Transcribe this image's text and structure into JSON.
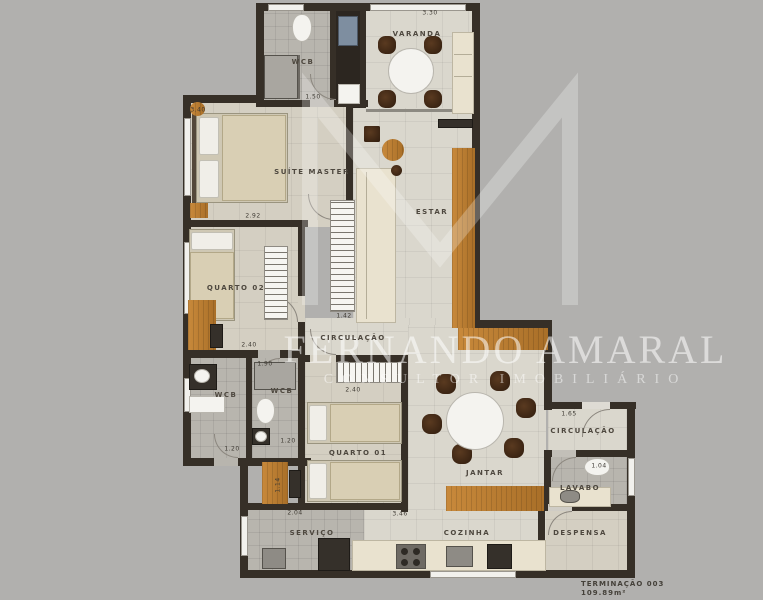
{
  "palette": {
    "background": "#b1b0ae",
    "wall": "#362f27",
    "wood_accent": "#bd7e33",
    "floor_light": "#dad7cd",
    "floor_beige": "#d4cfc2",
    "floor_tile": "#b8b5ae",
    "counter_cream": "#e9e2cf",
    "chair_dark": "#3b2517",
    "label_text": "#4e483f",
    "watermark_white": "rgba(255,255,255,0.55)"
  },
  "watermark": {
    "name": "FERNANDO AMARAL",
    "title": "CONSULTOR IMOBILIÁRIO"
  },
  "unit": {
    "code": "TERMINAÇÃO 003",
    "area": "109.89m²"
  },
  "plan": {
    "rooms": [
      {
        "label": "VARANDA"
      },
      {
        "label": "WCB"
      },
      {
        "label": "SUÍTE MASTER"
      },
      {
        "label": "ESTAR"
      },
      {
        "label": "QUARTO 02"
      },
      {
        "label": "CIRCULAÇÃO"
      },
      {
        "label": "WCB"
      },
      {
        "label": "WCB"
      },
      {
        "label": "QUARTO 01"
      },
      {
        "label": "JANTAR"
      },
      {
        "label": "CIRCULAÇÃO"
      },
      {
        "label": "LAVABO"
      },
      {
        "label": "DESPENSA"
      },
      {
        "label": "SERVIÇO"
      },
      {
        "label": "COZINHA"
      }
    ],
    "dimensions": [
      "3.30",
      "3.40",
      "1.50",
      "2.92",
      "1.42",
      "2.40",
      "1.90",
      "2.40",
      "1.20",
      "1.20",
      "1.14",
      "2.04",
      "3.46",
      "1.65",
      "1.04"
    ]
  }
}
